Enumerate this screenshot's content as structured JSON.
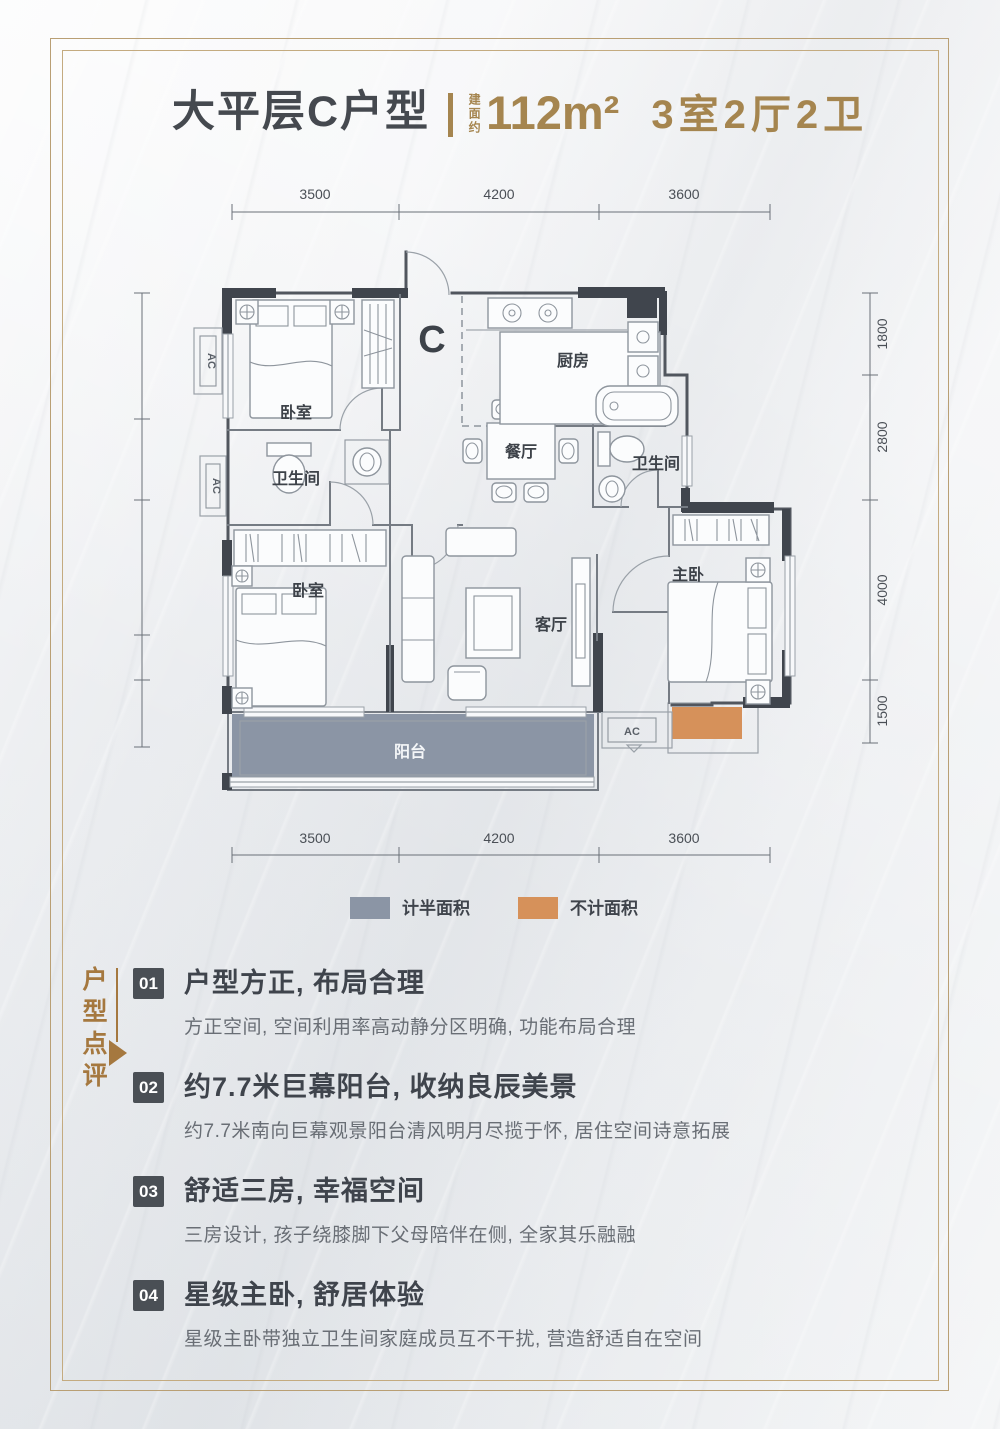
{
  "header": {
    "name": "大平层C户型",
    "area_label": "建面约",
    "area": "112m²",
    "spec": "3室2厅2卫"
  },
  "floorplan": {
    "unit_label": "C",
    "rooms": {
      "bedroom_top": "卧室",
      "bedroom_bottom": "卧室",
      "master": "主卧",
      "kitchen": "厨房",
      "dining": "餐厅",
      "living": "客厅",
      "bath_left": "卫生间",
      "bath_right": "卫生间",
      "balcony": "阳台"
    },
    "ac_label": "AC",
    "dimensions": {
      "top": [
        "3500",
        "4200",
        "3600"
      ],
      "bottom": [
        "3500",
        "4200",
        "3600"
      ],
      "left": [
        "2800",
        "1800",
        "3000",
        "1000",
        "1500"
      ],
      "right": [
        "1800",
        "2800",
        "4000",
        "1500"
      ]
    },
    "legend": [
      {
        "label": "计半面积",
        "color": "#8b95a5"
      },
      {
        "label": "不计面积",
        "color": "#d6915a"
      }
    ]
  },
  "review": {
    "section_label": "户型点评",
    "items": [
      {
        "num": "01",
        "title": "户型方正, 布局合理",
        "desc": "方正空间, 空间利用率高动静分区明确, 功能布局合理"
      },
      {
        "num": "02",
        "title": "约7.7米巨幕阳台, 收纳良辰美景",
        "desc": "约7.7米南向巨幕观景阳台清风明月尽揽于怀, 居住空间诗意拓展"
      },
      {
        "num": "03",
        "title": "舒适三房, 幸福空间",
        "desc": "三房设计, 孩子绕膝脚下父母陪伴在侧, 全家其乐融融"
      },
      {
        "num": "04",
        "title": "星级主卧, 舒居体验",
        "desc": "星级主卧带独立卫生间家庭成员互不干扰, 营造舒适自在空间"
      }
    ]
  },
  "colors": {
    "accent_gold": "#a5854f",
    "frame_gold": "#b99f74",
    "text_dark": "#45494f",
    "text_body": "#696e75",
    "badge": "#4a4f55",
    "review_brown": "#a5783f",
    "half_area_fill": "#8b95a5",
    "excluded_fill": "#d6915a",
    "wall": "#51565e"
  }
}
